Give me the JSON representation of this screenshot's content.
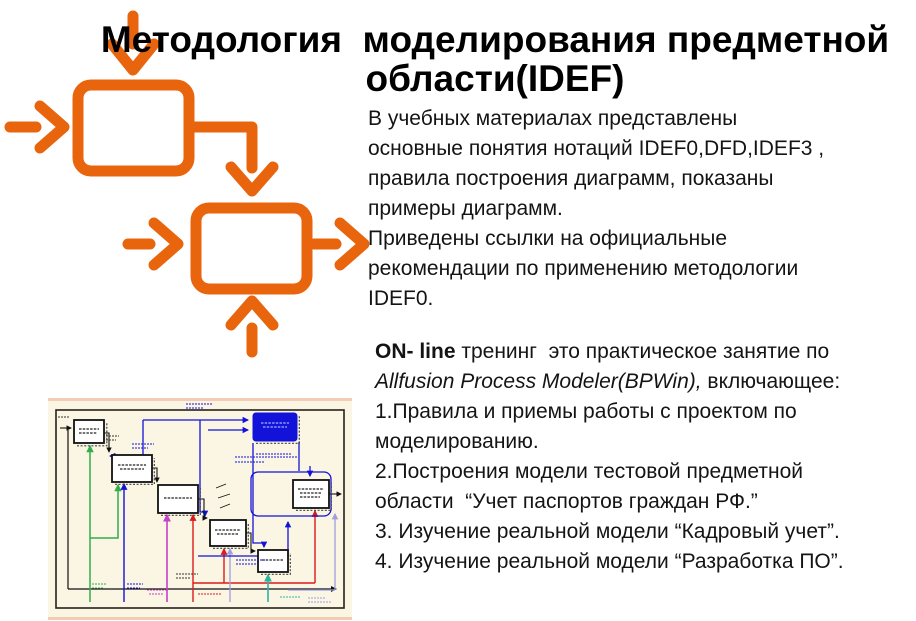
{
  "slide_title": "Методология  моделирования предметной\nобласти(IDEF)",
  "intro_text": "В учебных материалах представлены\nосновные понятия нотаций IDEF0,DFD,IDEF3 ,\nправила построения диаграмм, показаны\nпримеры диаграмм.\nПриведены ссылки на официальные\nрекомендации по применению методологии\nIDEF0.",
  "training": {
    "lead_bold": "ON- line",
    "lead_rest": " тренинг  это практическое занятие по\n",
    "tool_italic": "Allfusion Process Modeler(BPWin),",
    "tail": " включающее:\n1.Правила и приемы работы с проектом по\nмоделированию.\n2.Построения модели тестовой предметной\nобласти  “Учет паспортов граждан РФ.”\n3. Изучение реальной модели “Кадровый учет”.\n4. Изучение реальной модели “Разработка ПО”."
  },
  "figures": {
    "left_diagram_icon": "idef0-two-activity-boxes-with-arrows-icon",
    "thumbnail_icon": "bpwin-process-model-screenshot-icon"
  },
  "palette": {
    "accent_orange": "#E8640D",
    "title_text": "#000000",
    "body_text": "#141414",
    "thumb_background": "#FBF6E3",
    "thumb_frame": "#26221C",
    "thumb_blue": "#1212D8",
    "thumb_green": "#2FAE4A",
    "thumb_magenta": "#C83FC8",
    "thumb_red": "#DC1A1A",
    "thumb_teal": "#2BB5A0",
    "thumb_lavender": "#9E9EE0"
  }
}
